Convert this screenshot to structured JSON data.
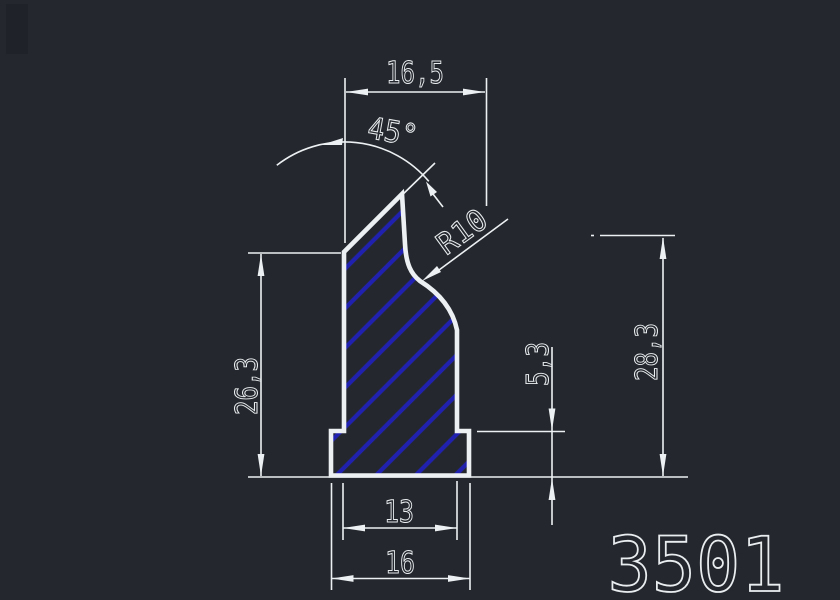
{
  "part_number": "3501",
  "dimensions": {
    "top_width": "16,5",
    "angle": "45°",
    "radius": "R10",
    "body_height": "26,3",
    "flange_height": "5,3",
    "overall_height": "28,3",
    "inner_width": "13",
    "outer_width": "16"
  },
  "colors": {
    "background": "#24282e",
    "line": "#edf0f2",
    "hatch": "#2121b0",
    "text": "#e9edef",
    "corner_shadow": "#1f2329"
  }
}
